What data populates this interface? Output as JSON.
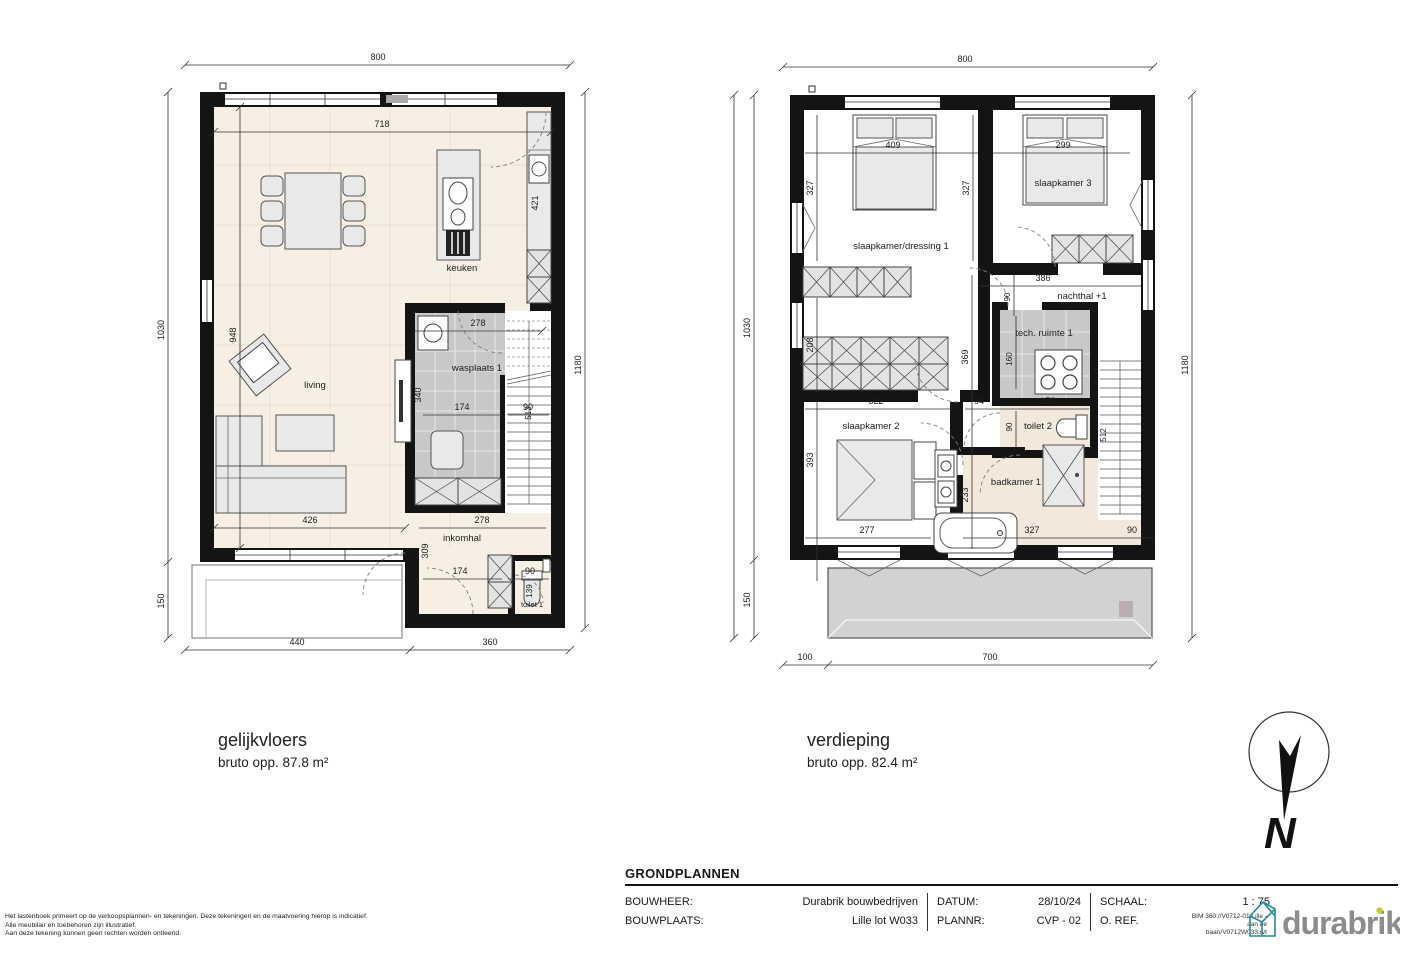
{
  "ground": {
    "title": "gelijkvloers",
    "subtitle": "bruto opp. 87.8 m²",
    "rooms": {
      "living": "living",
      "keuken": "keuken",
      "wasplaats": "wasplaats 1",
      "inkomhal": "inkomhal",
      "toilet": "toilet 1"
    },
    "dims": {
      "total_w": "800",
      "inner_w": "718",
      "left_h": "1030",
      "right_h": "1180",
      "living_h": "948",
      "terrace_h": "150",
      "bottom_l": "440",
      "bottom_r": "360",
      "kitchen_d": "421",
      "waspl_w": "278",
      "waspl_h": "340",
      "waspl_inner": "174",
      "stair_w": "90",
      "stair_l": "513",
      "living_w": "426",
      "hall_w": "278",
      "hall_h": "309",
      "hall_inner": "174",
      "wc_w": "90",
      "wc_d": "139"
    }
  },
  "upper": {
    "title": "verdieping",
    "subtitle": "bruto opp. 82.4 m²",
    "rooms": {
      "sk1": "slaapkamer/dressing 1",
      "sk3": "slaapkamer 3",
      "nachthal": "nachthal +1",
      "tech": "tech. ruimte 1",
      "toilet": "toilet 2",
      "sk2": "slaapkamer 2",
      "badkamer": "badkamer 1"
    },
    "dims": {
      "total_w": "800",
      "left_h": "1030",
      "right_h": "1180",
      "terrace_h": "150",
      "bottom_l": "100",
      "bottom_r": "700",
      "bed1_w": "409",
      "bed3_w": "299",
      "sk1_h": "327",
      "sk3_h": "327",
      "dress_h": "208",
      "ward_w": "322",
      "mid_h": "369",
      "gap_w": "94",
      "nachthal_w": "386",
      "nachthal_d": "90",
      "tech_h": "160",
      "wc2_w": "178",
      "wc2_d": "90",
      "stair_l": "512",
      "sk2_h": "393",
      "bed2_w": "277",
      "bad_h": "233",
      "bad_w": "327",
      "stair_w": "90"
    }
  },
  "titleblock": {
    "title": "GRONDPLANNEN",
    "bouwheer_label": "BOUWHEER:",
    "bouwheer_value": "Durabrik bouwbedrijven",
    "bouwplaats_label": "BOUWPLAATS:",
    "bouwplaats_value": "Lille lot W033",
    "datum_label": "DATUM:",
    "datum_value": "28/10/24",
    "plannr_label": "PLANNR:",
    "plannr_value": "CVP - 02",
    "schaal_label": "SCHAAL:",
    "schaal_value": "1 : 75",
    "oref_label": "O. REF.",
    "bim_line1": "BIM 360://V0712-01 Lille -",
    "bim_line2": "aan de",
    "bim_line3": "baan/V0712W033.rvt"
  },
  "logo": {
    "text": "durabrik",
    "gray": "#8c8c8c",
    "teal": "#1b8f9e",
    "accent": "#c3d021"
  },
  "north": {
    "label": "N"
  },
  "disclaimer": {
    "line1": "Het lastenboek primeert op de verkoopsplannen- en tekeningen. Deze tekeningen en de maatvoering hierop is indicatief.",
    "line2": "Alle meubilair en toebehoren zijn illustratief.",
    "line3": "Aan deze tekening kunnen geen rechten worden ontleend."
  }
}
